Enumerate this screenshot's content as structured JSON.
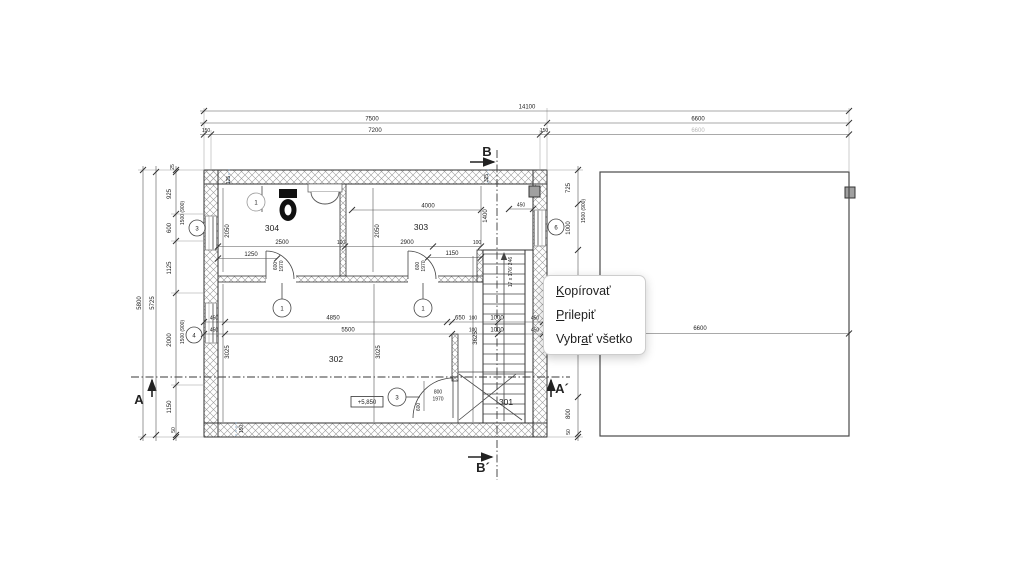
{
  "context_menu": {
    "items": [
      {
        "pre": "",
        "key": "K",
        "post": "opírovať"
      },
      {
        "pre": "",
        "key": "P",
        "post": "rilepiť"
      },
      {
        "pre": "Vybr",
        "key": "a",
        "post": "ť všetko"
      }
    ]
  },
  "plan": {
    "rooms": {
      "r301": "301",
      "r302": "302",
      "r303": "303",
      "r304": "304"
    },
    "level_mark": "+5,850",
    "stair_note": "17 x 176/ 246",
    "section_marks": {
      "b": "B",
      "b_prime": "B´",
      "a": "A",
      "a_prime": "A´"
    },
    "opening_marks": {
      "window3": "3",
      "window4": "4",
      "window6": "6",
      "door1a": "1",
      "door1b": "1",
      "door1c": "1",
      "door3": "3"
    }
  },
  "dims": {
    "top": {
      "total": "14100",
      "left": "7500",
      "right": "6600",
      "wall_l": "150",
      "inner": "7200",
      "wall_r": "150",
      "right_sub": "6600"
    },
    "left": {
      "total": "5800",
      "inner": "5725",
      "s1": "25",
      "s2": "925",
      "s3": "600",
      "s4": "1125",
      "s5": "2000",
      "s6": "1150",
      "s7": "50",
      "parapet_a": "1500 (900)",
      "parapet_b": "1500 (900)"
    },
    "right": {
      "s1": "725",
      "s2": "1000",
      "s3": "800",
      "s4": "50",
      "parapet": "1500 (900)"
    },
    "terrace": {
      "width": "6600"
    },
    "inner": {
      "a4000": "4000",
      "a1400": "1400",
      "a2050a": "2050",
      "a2050b": "2050",
      "a2500": "2500",
      "a100a": "100",
      "a2900": "2900",
      "a100b": "100",
      "a1250": "1250",
      "a1150": "1150",
      "da600a": "600",
      "da1970a": "1970",
      "da600b": "600",
      "da1970b": "1970",
      "a450wa": "450",
      "a4850": "4850",
      "a650": "650",
      "a100c": "100",
      "a1000a": "1000",
      "a450a": "450",
      "a450wb": "450",
      "a5500": "5500",
      "a100d": "100",
      "a1000b": "1000",
      "a450b": "450",
      "a3025a": "3025",
      "a3025b": "3025",
      "a3625": "3625",
      "a325": "325",
      "a125": "125",
      "a450t": "450",
      "a150": "150",
      "da800": "800",
      "da1970c": "1970",
      "da600c": "600"
    }
  },
  "colors": {
    "line": "#3a3a3a",
    "hatch": "#9b9b9b",
    "menu_border": "#cdcdcd",
    "faded_dim": "#b8b8b8",
    "marker_fill": "#a0a0a0"
  }
}
